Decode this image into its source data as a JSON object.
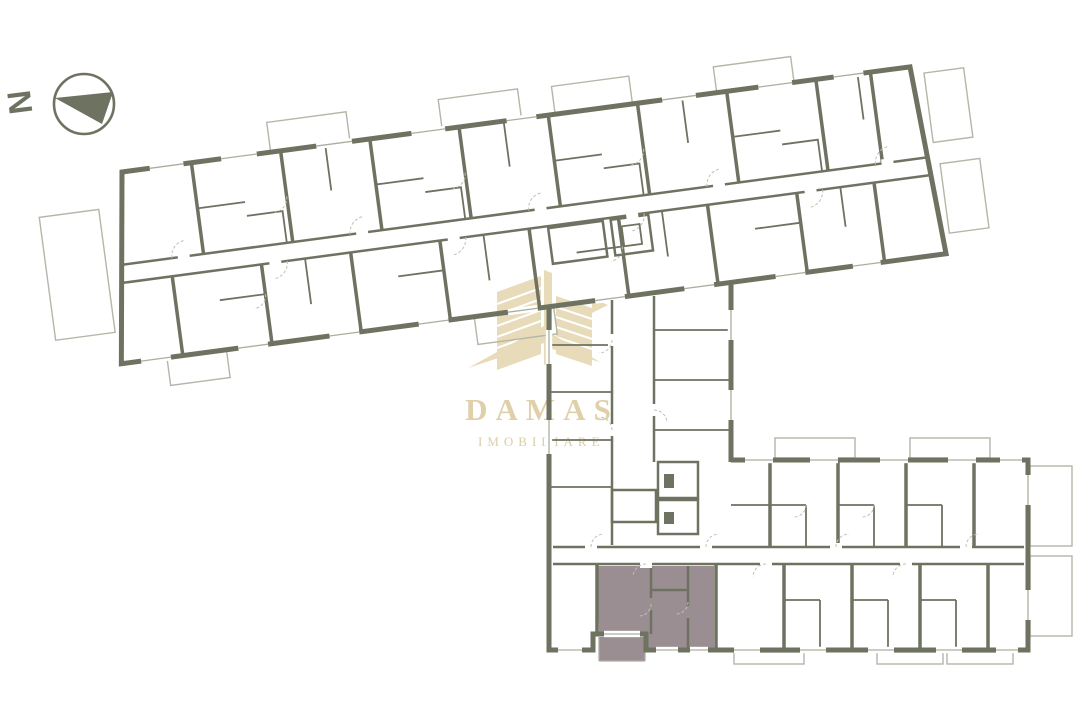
{
  "compass": {
    "label": "N"
  },
  "watermark": {
    "brand": "DAMAS",
    "tagline": "IMOBILIARE",
    "color": "#e2d1a6"
  },
  "plan": {
    "wall_color": "#6e7261",
    "light_line_color": "#b2b7a8",
    "highlight_fill": "#9a8e93",
    "background": "#ffffff",
    "highlighted_unit": "south-wing-bottom-left-apartment",
    "sections": [
      "north-wing",
      "central-stair-core",
      "south-wing"
    ]
  }
}
